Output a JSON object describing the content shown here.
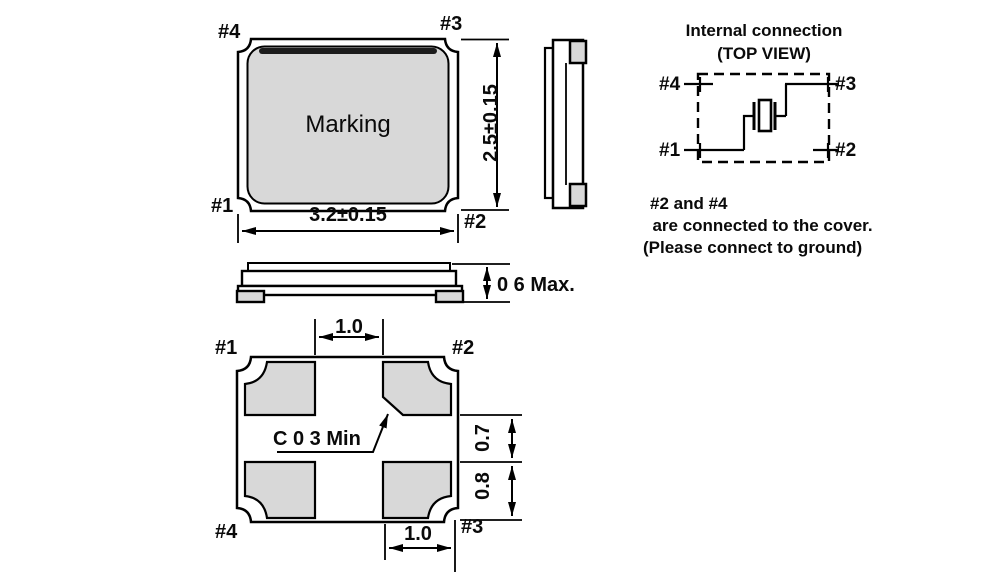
{
  "colors": {
    "pad_fill": "#d8d8d8",
    "line": "#000000"
  },
  "top_view": {
    "pins": {
      "p1": "#1",
      "p2": "#2",
      "p3": "#3",
      "p4": "#4"
    },
    "marking": "Marking",
    "width_dim": "3.2±0.15",
    "height_dim": "2.5±0.15"
  },
  "profile_view": {
    "height_dim": "0 6 Max."
  },
  "internal_connection": {
    "title": "Internal connection",
    "subtitle": "(TOP VIEW)",
    "pins": {
      "p1": "#1",
      "p2": "#2",
      "p3": "#3",
      "p4": "#4"
    },
    "note_line1": "#2 and #4",
    "note_line2": "  are connected to the cover.",
    "note_line3": "(Please connect to ground)"
  },
  "bottom_view": {
    "pins": {
      "p1": "#1",
      "p2": "#2",
      "p3": "#3",
      "p4": "#4"
    },
    "top_pitch_dim": "1.0",
    "bottom_pitch_dim": "1.0",
    "pad_gap_dim": "0.7",
    "pad_height_dim": "0.8",
    "chamfer_note": "C 0 3 Min"
  }
}
